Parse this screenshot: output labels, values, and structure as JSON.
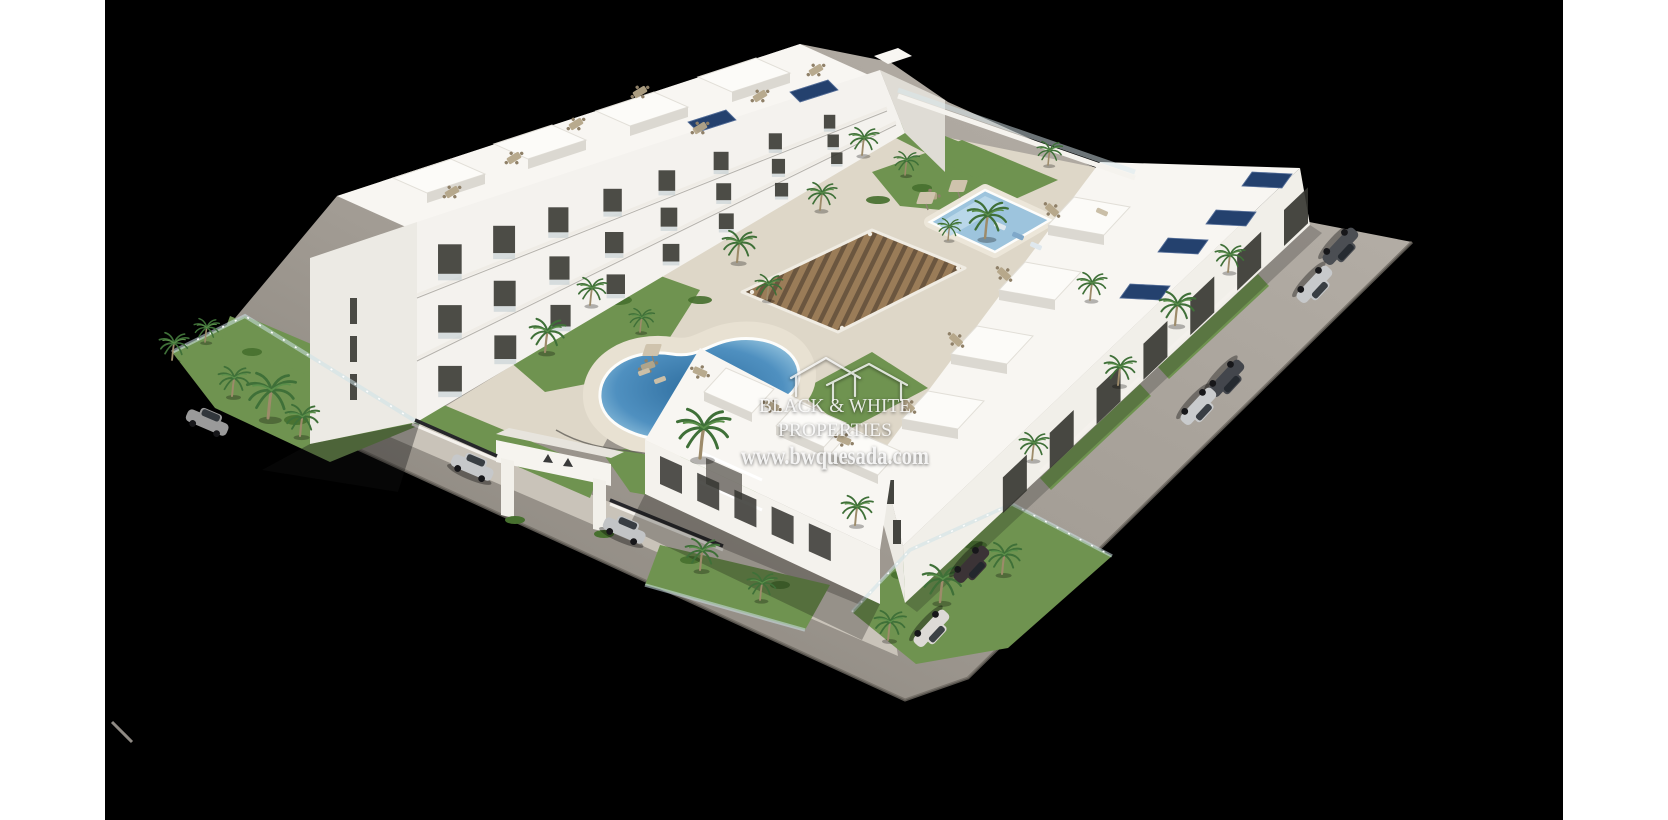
{
  "image": {
    "kind": "architectural aerial 3D render",
    "subject": "White modern apartment complex with communal kidney pool, lap pool, gardens, palm trees, pergola, entrance arch and perimeter road with parked cars",
    "page_background": "#ffffff",
    "render_background": "#000000"
  },
  "watermark": {
    "logo_icon": "black-white-properties-houses-logo",
    "line1": "BLACK & WHITE",
    "line2": "PROPERTIES",
    "line3": "www.bwquesada.com"
  },
  "colors": {
    "page-bg": "#ffffff",
    "render-bg": "#000000",
    "road": "#a9a39b",
    "road-dark": "#827d76",
    "parking-strip": "#c9c3b9",
    "sand": "#ded7c8",
    "building-light": "#f8f6f2",
    "building-mid": "#eceae4",
    "building-shade": "#dfdcd5",
    "window-dark": "#34342f",
    "grass": "#6f9350",
    "grass-dark": "#47702f",
    "palm": "#3f7038",
    "trunk": "#9d8b6a",
    "pool-deep": "#2e6d9e",
    "pool-light": "#7fb3d4",
    "pool2": "#9dc4dd",
    "pergola-dark": "#6b563f",
    "pergola-light": "#9a7c58",
    "solar": "#24416e",
    "watermark": "#ffffff"
  },
  "scene_inventory": {
    "pools": 2,
    "building_rows": 3,
    "parked_cars": 9,
    "entrance_arches": 1,
    "pergolas": 1
  }
}
